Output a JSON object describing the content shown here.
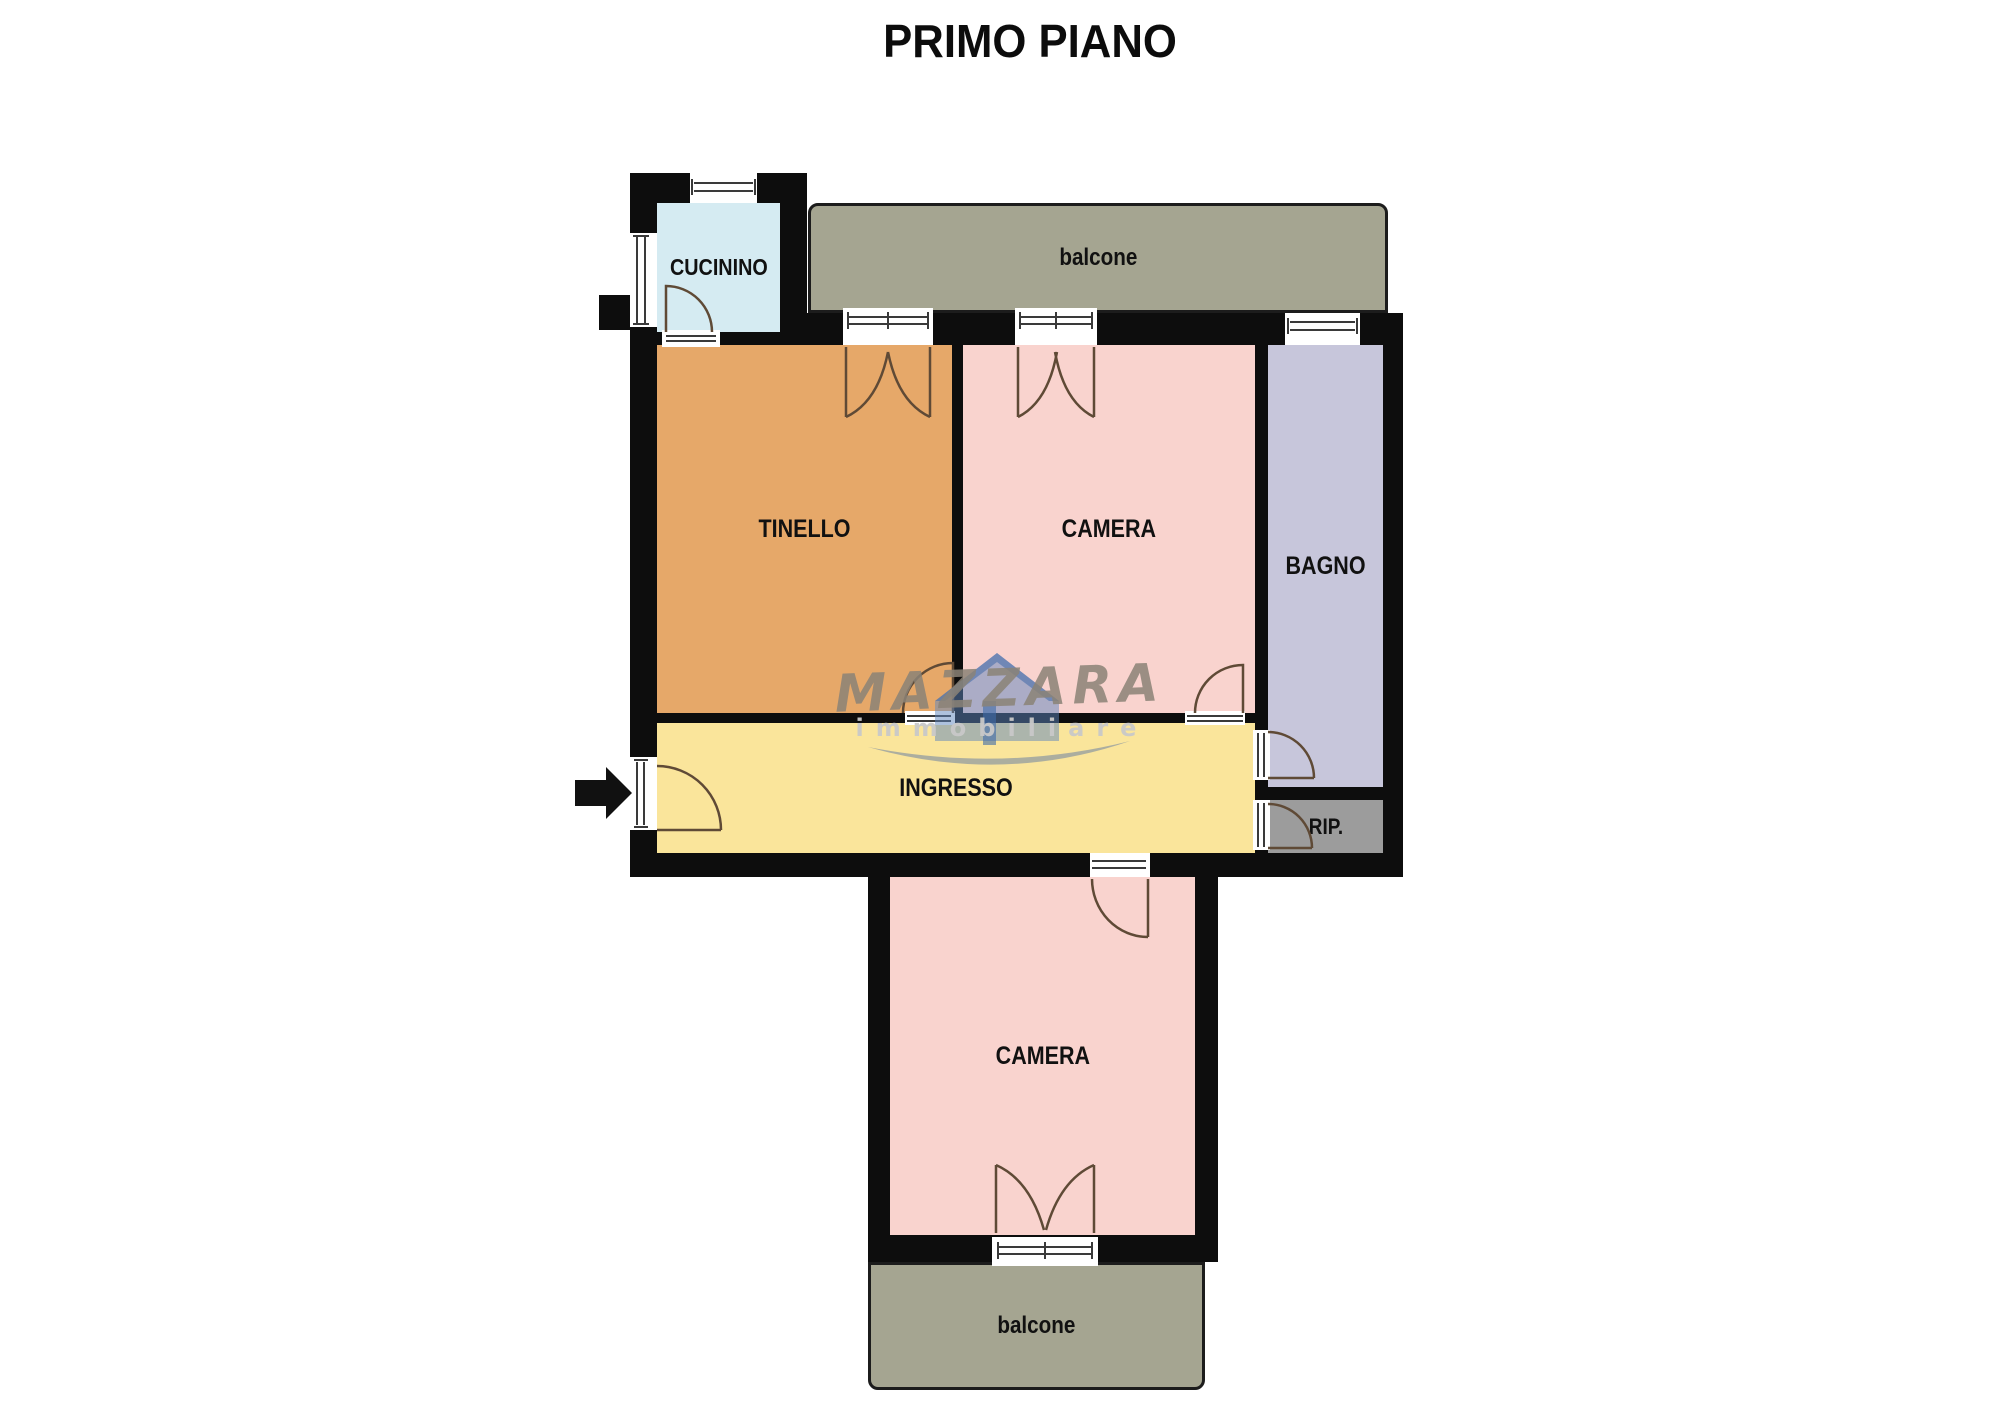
{
  "title": "PRIMO PIANO",
  "rooms": {
    "cucinino": {
      "label": "CUCININO",
      "color": "#d5ebf2"
    },
    "balcone_top": {
      "label": "balcone",
      "color": "#a5a591"
    },
    "tinello": {
      "label": "TINELLO",
      "color": "#e6a869"
    },
    "camera_top": {
      "label": "CAMERA",
      "color": "#f9d3ce"
    },
    "bagno": {
      "label": "BAGNO",
      "color": "#c7c6db"
    },
    "ingresso": {
      "label": "INGRESSO",
      "color": "#fae59b"
    },
    "rip": {
      "label": "RIP.",
      "color": "#9c9c9c"
    },
    "camera_bottom": {
      "label": "CAMERA",
      "color": "#f9d3ce"
    },
    "balcone_bottom": {
      "label": "balcone",
      "color": "#a5a591"
    }
  },
  "watermark": {
    "brand": "MAZZARA",
    "tagline": "immobiliare",
    "house_color": "#5d86bd",
    "roof_color": "#3f6aa8",
    "text_color": "#8b8377",
    "tagline_color": "#c9c9c9",
    "swoosh_color": "#98a0a0"
  },
  "colors": {
    "background": "#ffffff",
    "wall": "#0d0d0d",
    "door_stroke": "#5f4a36",
    "window_stroke": "#3a3a3a",
    "entrance_arrow": "#111111"
  }
}
